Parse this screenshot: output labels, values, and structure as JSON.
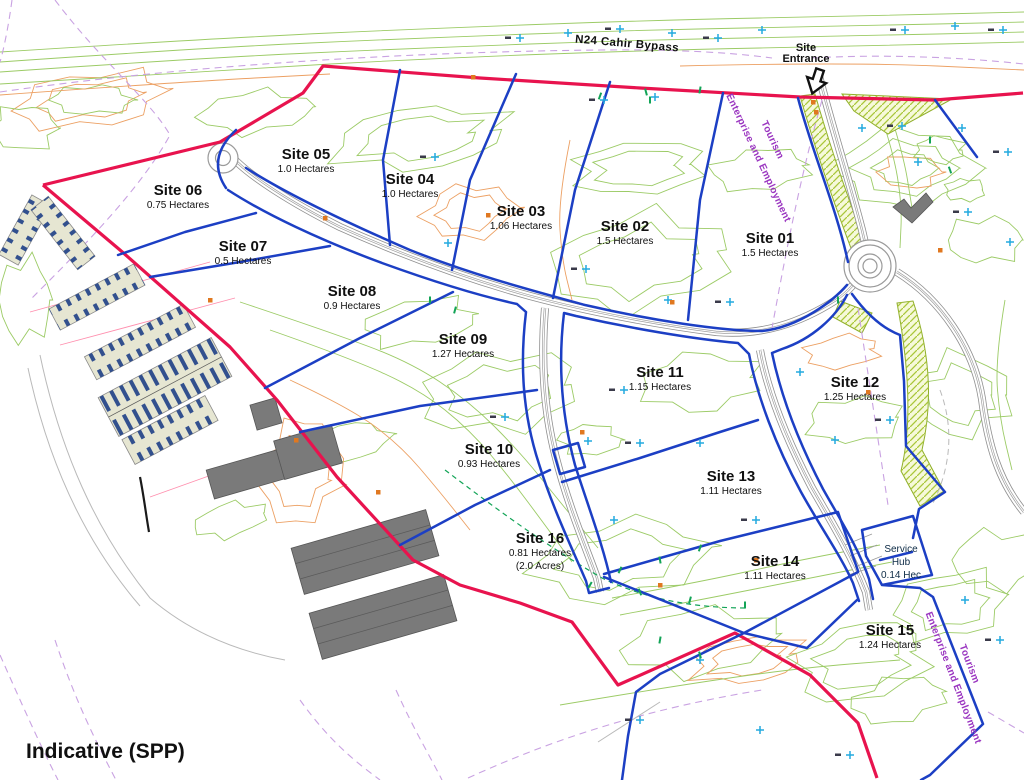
{
  "map": {
    "footer_label": "Indicative (SPP)",
    "bypass_label": "N24 Cahir Bypass",
    "entrance": {
      "line1": "Site",
      "line2": "Entrance"
    },
    "corridor_label": {
      "line1": "Tourism",
      "line2": "Enterprise and Employment"
    },
    "service_hub": {
      "name_line1": "Service",
      "name_line2": "Hub",
      "area": "0.14 Hec",
      "cx": 901,
      "cy": 543
    },
    "sites": [
      {
        "name": "Site 01",
        "area": "1.5 Hectares",
        "cx": 770,
        "cy": 240
      },
      {
        "name": "Site 02",
        "area": "1.5 Hectares",
        "cx": 625,
        "cy": 228
      },
      {
        "name": "Site 03",
        "area": "1.06 Hectares",
        "cx": 521,
        "cy": 213
      },
      {
        "name": "Site 04",
        "area": "1.0 Hectares",
        "cx": 410,
        "cy": 181
      },
      {
        "name": "Site 05",
        "area": "1.0 Hectares",
        "cx": 306,
        "cy": 156
      },
      {
        "name": "Site 06",
        "area": "0.75 Hectares",
        "cx": 178,
        "cy": 192
      },
      {
        "name": "Site 07",
        "area": "0.5 Hectares",
        "cx": 243,
        "cy": 248
      },
      {
        "name": "Site 08",
        "area": "0.9 Hectares",
        "cx": 352,
        "cy": 293
      },
      {
        "name": "Site 09",
        "area": "1.27 Hectares",
        "cx": 463,
        "cy": 341
      },
      {
        "name": "Site 10",
        "area": "0.93 Hectares",
        "cx": 489,
        "cy": 451
      },
      {
        "name": "Site 11",
        "area": "1.15 Hectares",
        "cx": 660,
        "cy": 374
      },
      {
        "name": "Site 12",
        "area": "1.25 Hectares",
        "cx": 855,
        "cy": 384
      },
      {
        "name": "Site 13",
        "area": "1.11 Hectares",
        "cx": 731,
        "cy": 478
      },
      {
        "name": "Site 14",
        "area": "1.11 Hectares",
        "cx": 775,
        "cy": 563
      },
      {
        "name": "Site 15",
        "area": "1.24 Hectares",
        "cx": 890,
        "cy": 632
      },
      {
        "name": "Site 16",
        "area": "0.81 Hectares",
        "area2": "(2.0 Acres)",
        "cx": 540,
        "cy": 540
      }
    ],
    "colors": {
      "boundary_red": "#e8134e",
      "plot_blue": "#1c3fc4",
      "contour_green": "#9ccb66",
      "contour_green_dark": "#13a457",
      "contour_orange": "#eca063",
      "parcel_purple": "#c9a2e2",
      "corridor_text_purple": "#9a35c0",
      "survey_cyan": "#23aadf",
      "road_gray": "#9a9a9a",
      "building_gray": "#7a7a7a",
      "pink_line": "#ff8fae",
      "hatch_line": "#a9c63a",
      "hatch_bg": "#f6f9da",
      "hatch_edge": "#8fae2a",
      "caravan_fill": "#e6e6d2",
      "caravan_unit_blue": "#32508e"
    }
  }
}
